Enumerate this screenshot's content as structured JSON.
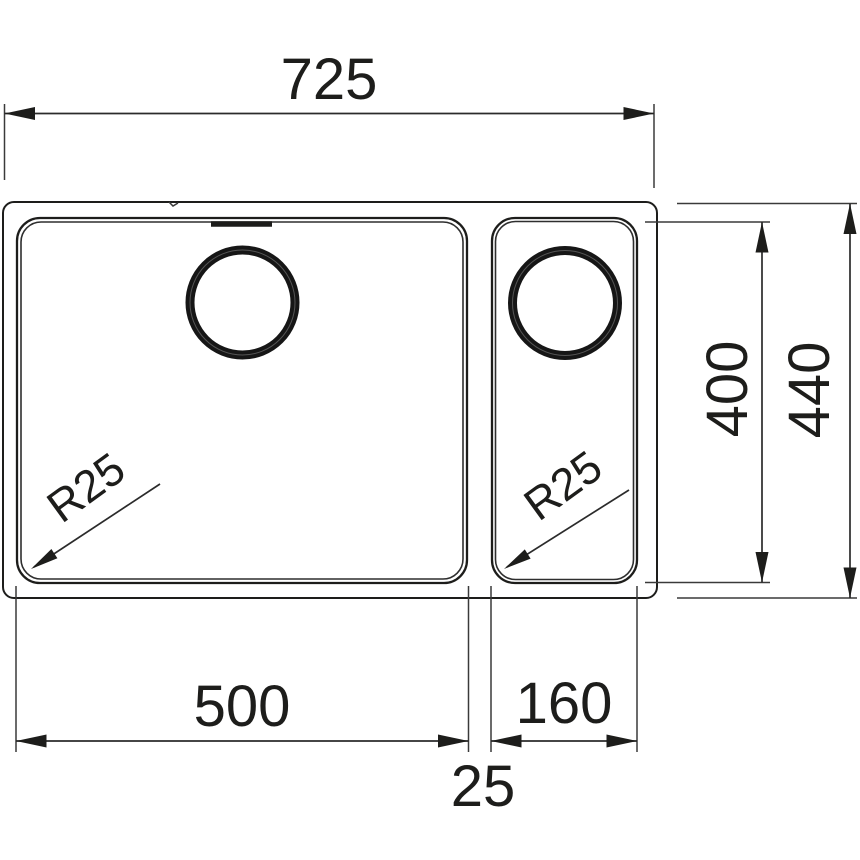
{
  "drawing": {
    "type": "technical-dimension-drawing",
    "subject": "double-bowl undermount sink, top view",
    "units_implied": "mm",
    "background_color": "#ffffff",
    "line_color": "#1d1d1b",
    "dims": {
      "overall_width": "725",
      "overall_depth": "440",
      "bowl_depth": "400",
      "main_bowl_width": "500",
      "small_bowl_width": "160",
      "divider_gap": "25",
      "main_bowl_radius": "R25",
      "small_bowl_radius": "R25"
    }
  }
}
